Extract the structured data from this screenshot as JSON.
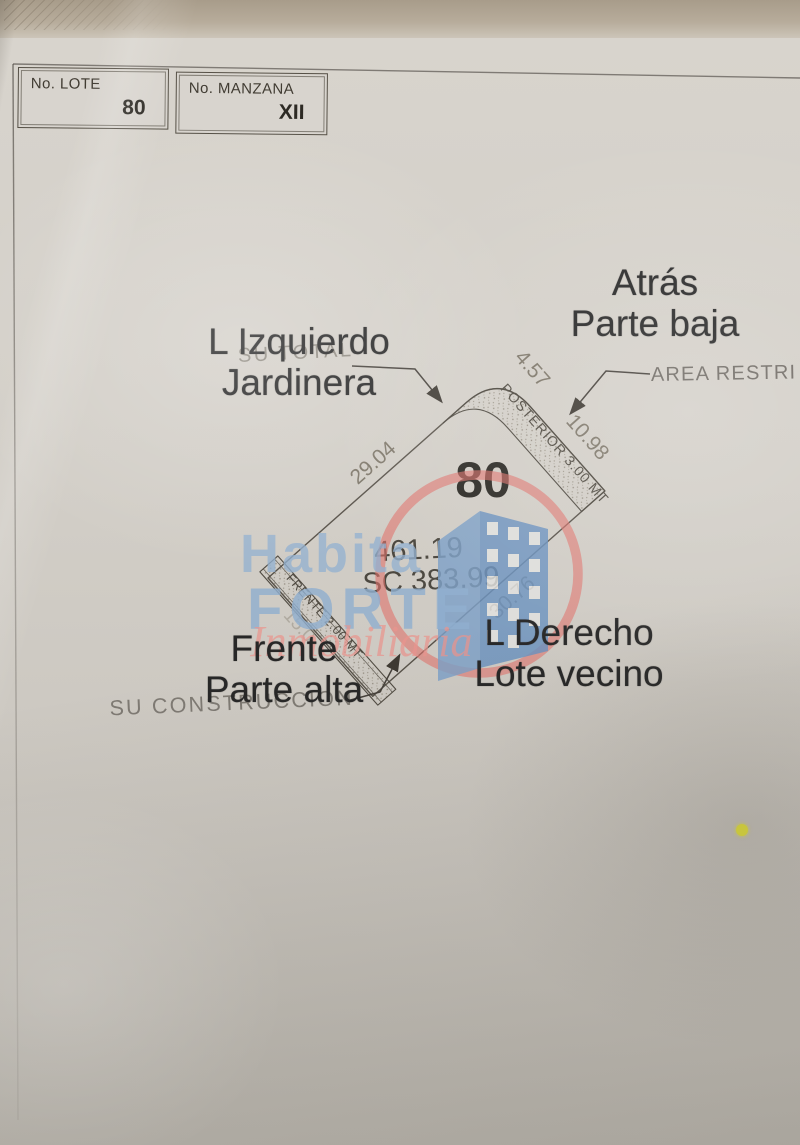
{
  "form": {
    "lote": {
      "label": "No. LOTE",
      "value": "80"
    },
    "manzana": {
      "label": "No. MANZANA",
      "value": "XII"
    }
  },
  "plan": {
    "lot_number": "80",
    "area_total": "461.19",
    "area_sc": "SC 383.99",
    "dimensions": {
      "left_edge": "29.04",
      "back_curve": "4.57",
      "right_upper": "10.98",
      "right_lower": "30.76",
      "front_faint": "15.0"
    },
    "bands": {
      "posterior": "POSTERIOR 3.00 MT",
      "frente": "FRENTE 2.00 MT"
    },
    "printed_labels": {
      "su_total": "SU TOTAL",
      "area_restringida": "AREA RESTRI",
      "su_construccion": "SU CONSTRUCCION"
    }
  },
  "annotations": {
    "izquierdo": {
      "line1": "L Izquierdo",
      "line2": "Jardinera"
    },
    "atras": {
      "line1": "Atrás",
      "line2": "Parte baja"
    },
    "frente": {
      "line1": "Frente",
      "line2": "Parte alta"
    },
    "derecho": {
      "line1": "L Derecho",
      "line2": "Lote vecino"
    }
  },
  "watermark": {
    "line1": "Habita",
    "line2": "FORTE",
    "line3": "Inmobiliaria",
    "blue": "#94b1cf",
    "red": "#e0736c"
  },
  "marker": {
    "yellow_dot_color": "#e9e73b"
  }
}
